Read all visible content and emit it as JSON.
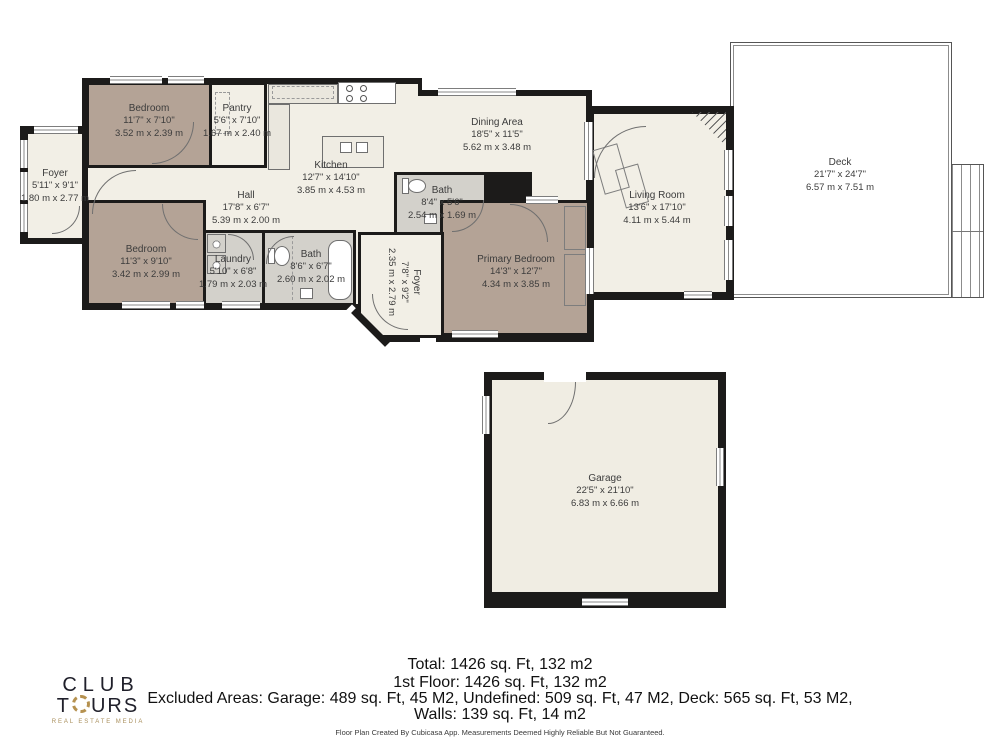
{
  "rooms": {
    "bedroom_tl": {
      "name": "Bedroom",
      "imperial": "11'7\" x 7'10\"",
      "metric": "3.52 m x 2.39 m"
    },
    "pantry": {
      "name": "Pantry",
      "imperial": "5'6\" x 7'10\"",
      "metric": "1.67 m x 2.40 m"
    },
    "foyer_left": {
      "name": "Foyer",
      "imperial": "5'11\" x 9'1\"",
      "metric": "1.80 m x 2.77 m"
    },
    "kitchen": {
      "name": "Kitchen",
      "imperial": "12'7\" x 14'10\"",
      "metric": "3.85 m x 4.53 m"
    },
    "dining": {
      "name": "Dining Area",
      "imperial": "18'5\" x 11'5\"",
      "metric": "5.62 m x 3.48 m"
    },
    "living": {
      "name": "Living Room",
      "imperial": "13'6\" x 17'10\"",
      "metric": "4.11 m x 5.44 m"
    },
    "deck": {
      "name": "Deck",
      "imperial": "21'7\" x 24'7\"",
      "metric": "6.57 m x 7.51 m"
    },
    "hall": {
      "name": "Hall",
      "imperial": "17'8\" x 6'7\"",
      "metric": "5.39 m x 2.00 m"
    },
    "bedroom_bl": {
      "name": "Bedroom",
      "imperial": "11'3\" x 9'10\"",
      "metric": "3.42 m x 2.99 m"
    },
    "laundry": {
      "name": "Laundry",
      "imperial": "5'10\" x 6'8\"",
      "metric": "1.79 m x 2.03 m"
    },
    "bath_main": {
      "name": "Bath",
      "imperial": "8'6\" x 6'7\"",
      "metric": "2.60 m x 2.02 m"
    },
    "bath_top": {
      "name": "Bath",
      "imperial": "8'4\" x 5'6\"",
      "metric": "2.54 m x 1.69 m"
    },
    "foyer_mid": {
      "name": "Foyer",
      "imperial": "7'8\" x 9'2\"",
      "metric": "2.35 m x 2.79 m"
    },
    "primary": {
      "name": "Primary Bedroom",
      "imperial": "14'3\" x 12'7\"",
      "metric": "4.34 m x 3.85 m"
    },
    "garage": {
      "name": "Garage",
      "imperial": "22'5\" x 21'10\"",
      "metric": "6.83 m x 6.66 m"
    }
  },
  "summary": {
    "total": "Total: 1426 sq. Ft, 132 m2",
    "first_floor": "1st Floor: 1426 sq. Ft, 132 m2",
    "excluded": "Excluded Areas: Garage: 489 sq. Ft, 45 M2, Undefined: 509 sq. Ft, 47 M2, Deck: 565 sq. Ft, 53 M2,",
    "walls": "Walls: 139 sq. Ft, 14 m2"
  },
  "logo": {
    "line1": "CLUB",
    "line2_start": "T",
    "line2_end": "URS",
    "tagline": "REAL ESTATE MEDIA"
  },
  "disclaimer": "Floor Plan Created By Cubicasa App. Measurements Deemed Highly Reliable But Not Guaranteed.",
  "colors": {
    "wall": "#1c1b1a",
    "floor": "#f2efe6",
    "bedroom": "#b4a396",
    "wet_room": "#d3d1cb",
    "garage_floor": "#f0ede3",
    "logo_gold": "#b5914f"
  }
}
